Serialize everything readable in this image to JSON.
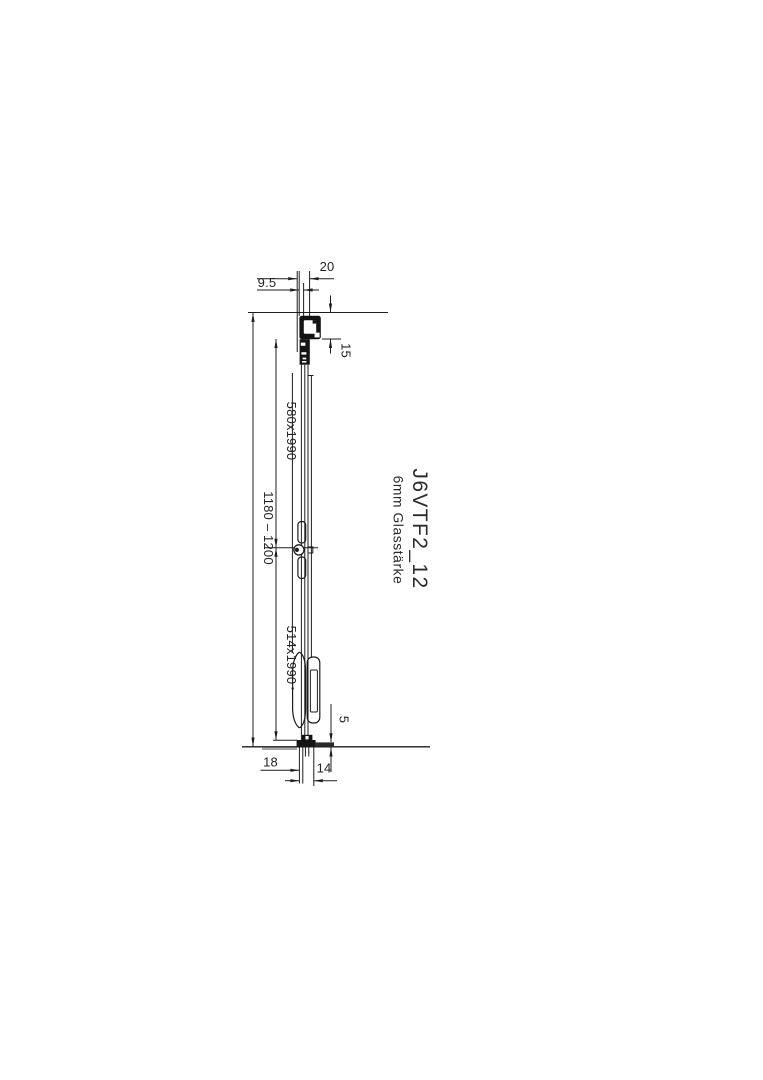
{
  "drawing": {
    "title": "J6VTF2_12",
    "subtitle": "6mm Glasstärke",
    "dimensions": {
      "top_offset": "9.5",
      "top_profile_width": "20",
      "top_profile_height": "15",
      "fixed_panel_size": "580x1990",
      "overall_range": "1180 – 1200",
      "sliding_panel_size": "514x1990",
      "floor_gap": "5",
      "bottom_left": "18",
      "bottom_right": "14"
    },
    "line_color": "#1d1d1d",
    "background_color": "#ffffff"
  }
}
